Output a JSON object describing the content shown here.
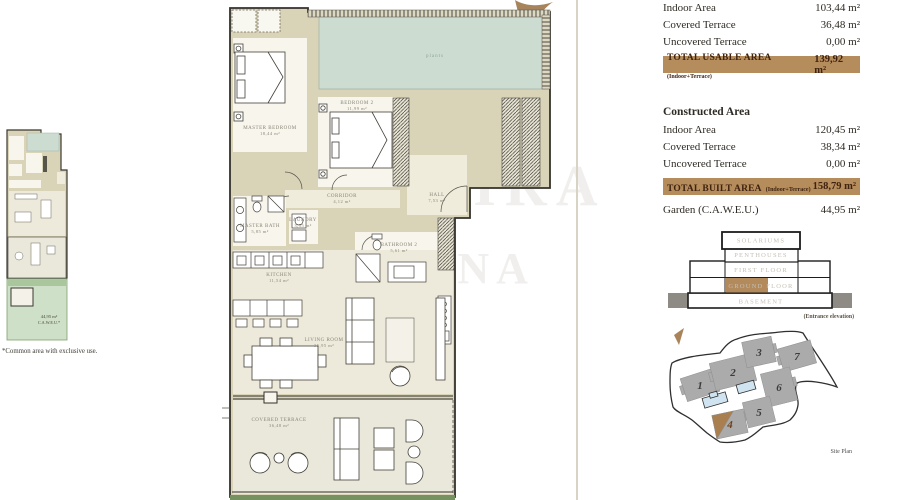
{
  "usable_area_table": {
    "rows": [
      {
        "label": "Indoor Area",
        "value": "103,44 m²"
      },
      {
        "label": "Covered Terrace",
        "value": "36,48 m²"
      },
      {
        "label": "Uncovered Terrace",
        "value": "0,00 m²"
      }
    ],
    "total": {
      "label": "TOTAL USABLE AREA",
      "qualifier": "(Indoor+Terrace)",
      "value": "139,92 m²"
    }
  },
  "constructed_area_table": {
    "header": "Constructed Area",
    "rows": [
      {
        "label": "Indoor Area",
        "value": "120,45 m²"
      },
      {
        "label": "Covered Terrace",
        "value": "38,34 m²"
      },
      {
        "label": "Uncovered Terrace",
        "value": "0,00 m²"
      }
    ],
    "total": {
      "label": "TOTAL BUILT AREA",
      "qualifier": "(Indoor+Terrace)",
      "value": "158,79 m²"
    },
    "garden": {
      "label": "Garden (C.A.W.E.U.)",
      "value": "44,95 m²"
    }
  },
  "elevation": {
    "floors": [
      "SOLARIUMS",
      "PENTHOUSES",
      "FIRST FLOOR",
      "GROUND FLOOR",
      "BASEMENT"
    ],
    "caption": "(Entrance elevation)"
  },
  "site_plan": {
    "caption": "Site Plan",
    "buildings": [
      "1",
      "2",
      "3",
      "7",
      "6",
      "5",
      "4"
    ],
    "highlighted_building": "4"
  },
  "floor_plan": {
    "plants_label": "plants",
    "rooms": [
      {
        "name": "MASTER BEDROOM",
        "area": "18,44 m²"
      },
      {
        "name": "BEDROOM 2",
        "area": "11,99 m²"
      },
      {
        "name": "CORRIDOR",
        "area": "4,12 m²"
      },
      {
        "name": "HALL",
        "area": "7,53 m²"
      },
      {
        "name": "MASTER BATH",
        "area": "5,85 m²"
      },
      {
        "name": "LAUNDRY",
        "area": "3,55 m²"
      },
      {
        "name": "BATHROOM 2",
        "area": "5,61 m²"
      },
      {
        "name": "KITCHEN",
        "area": "11,54 m²"
      },
      {
        "name": "LIVING ROOM",
        "area": "35,95 m²"
      },
      {
        "name": "COVERED TERRACE",
        "area": "36,48 m²"
      }
    ]
  },
  "thumbnail": {
    "garden_area": "44,95 m²",
    "garden_note": "C.A.W.E.U.*",
    "footnote": "*Common area with exclusive use."
  },
  "watermark": {
    "line1": "SIRA",
    "line2": "INTERNA",
    "line3": "WWW"
  },
  "colors": {
    "accent_band": "#b58c5b",
    "ground_floor_highlight": "#b28a5c",
    "building_highlight": "#a97f50",
    "pool": "#cfe4f0",
    "plants": "#ccdcd1",
    "garden": "#cfe0c8"
  }
}
